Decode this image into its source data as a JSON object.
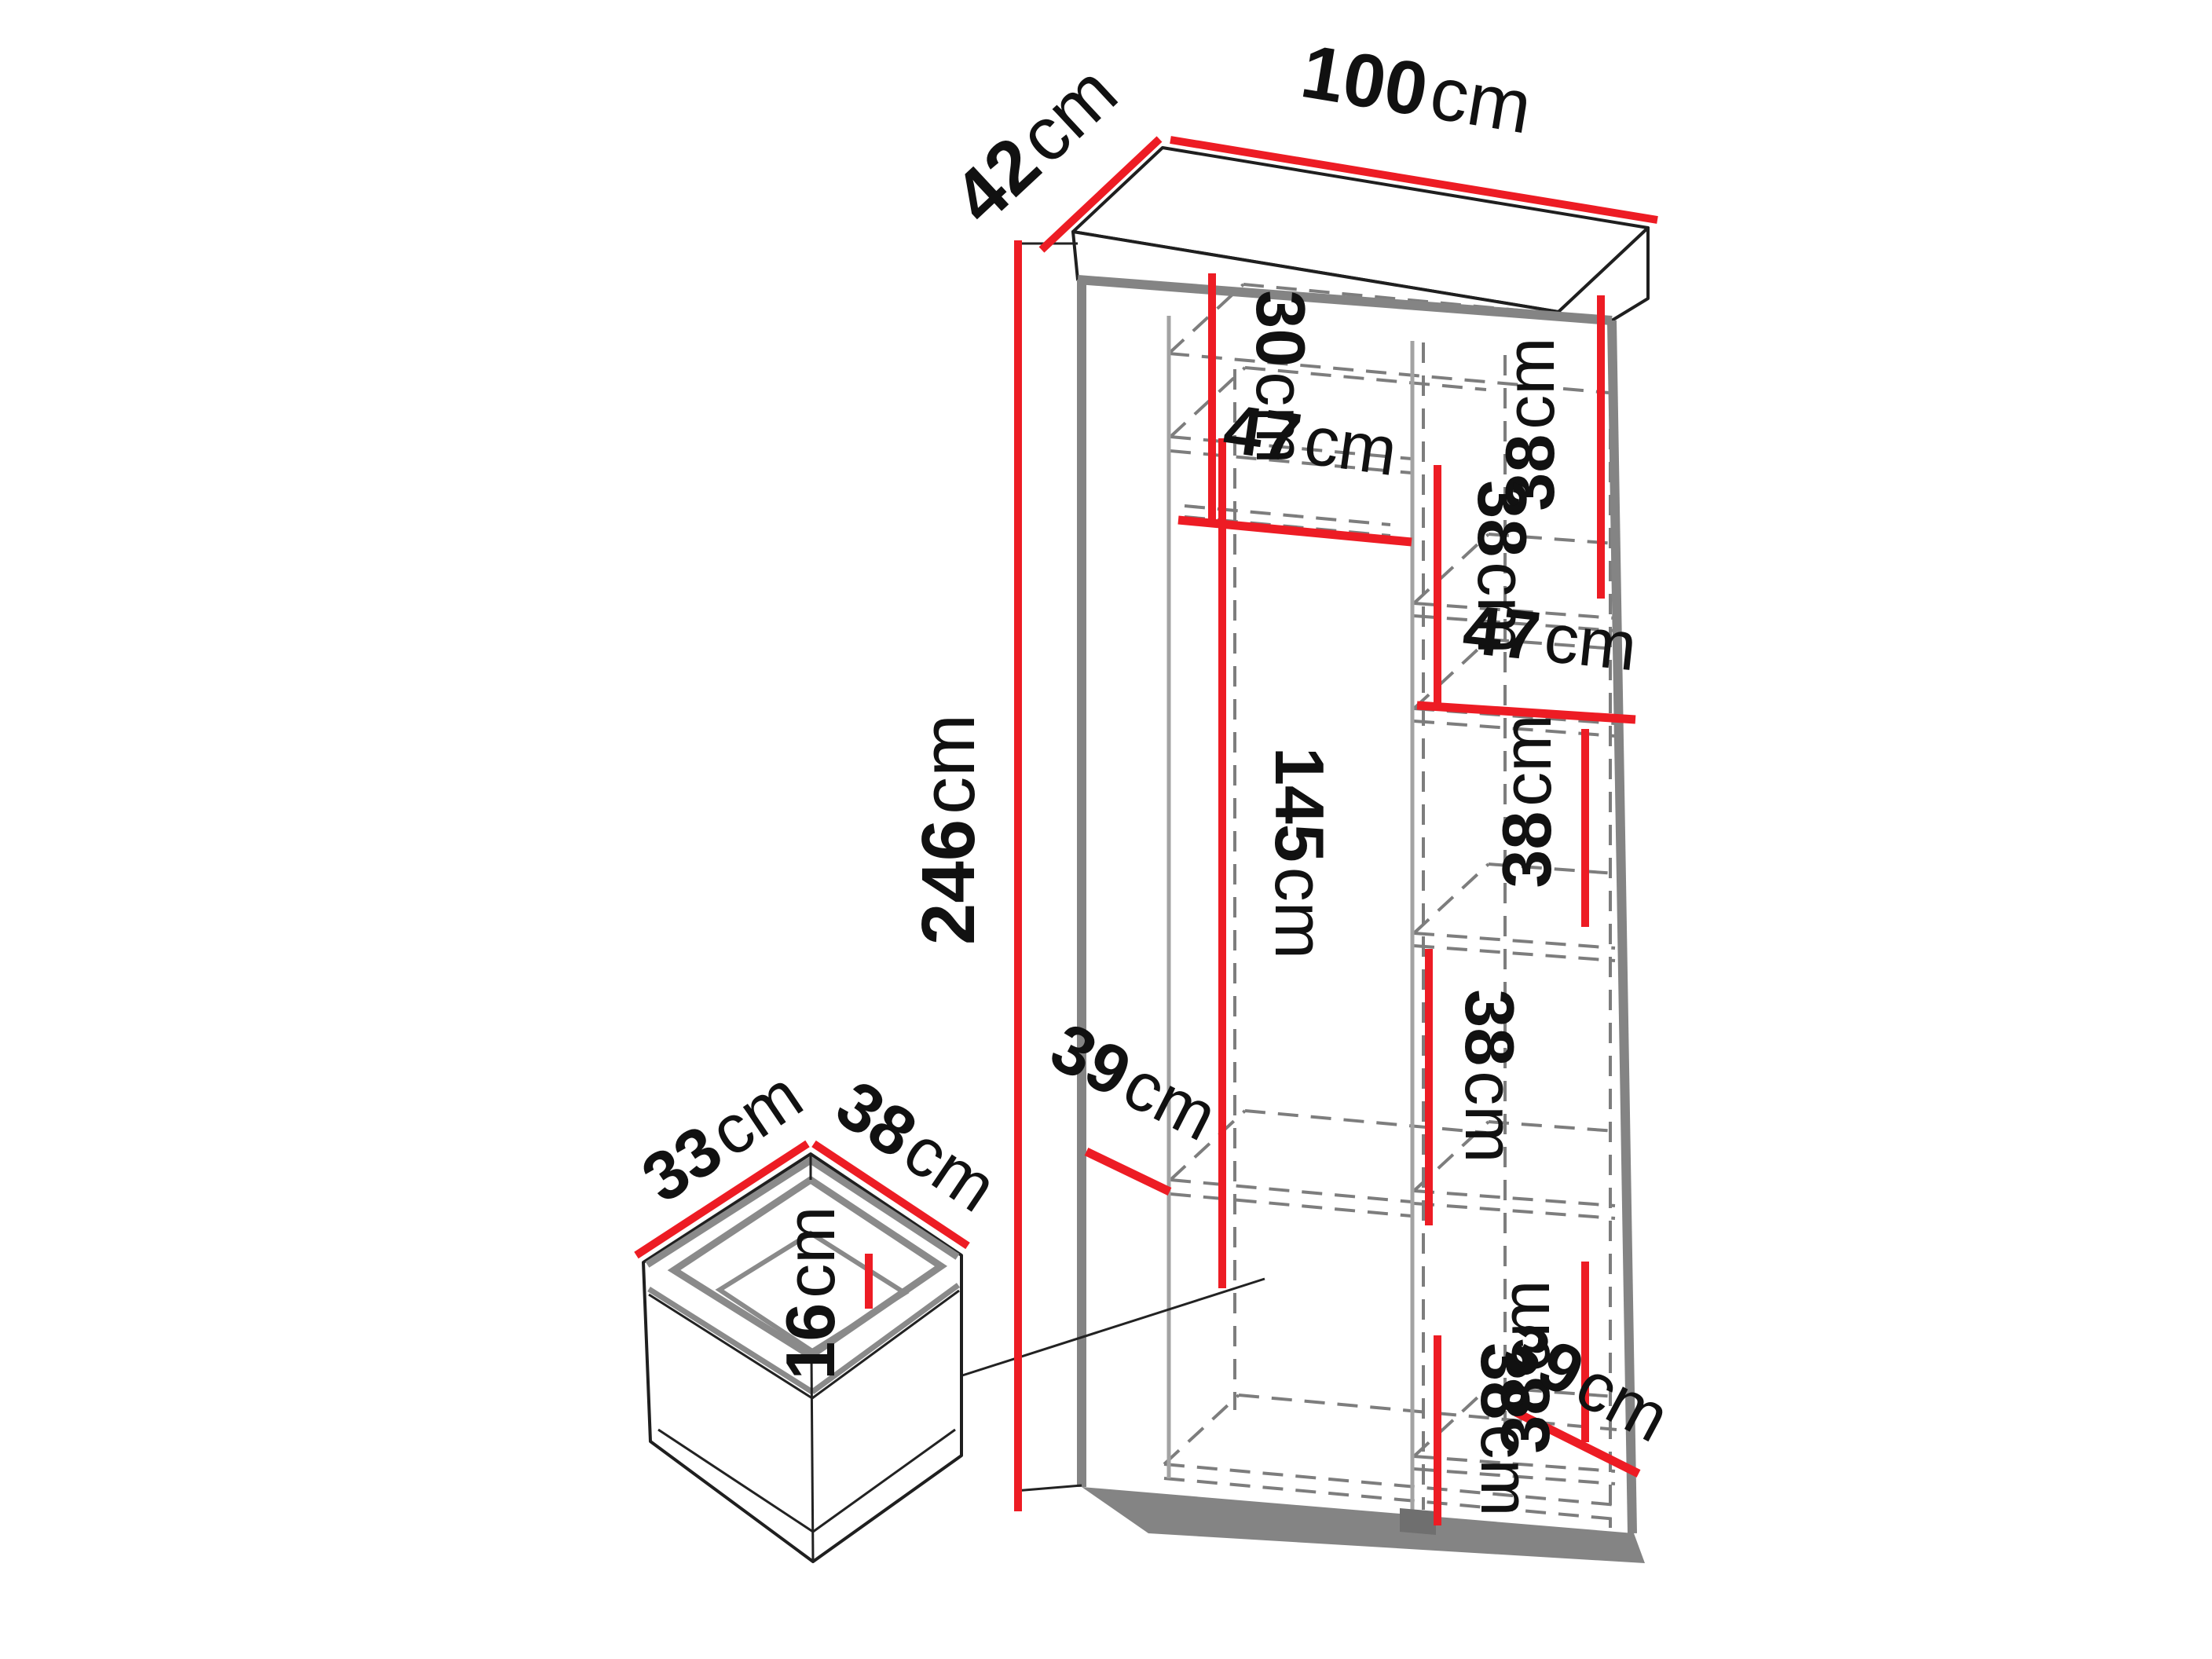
{
  "meta": {
    "background": "#ffffff",
    "accent_red": "#ED1C24",
    "edge_gray": "#848484",
    "text_color": "#111111",
    "diagram_type": "wardrobe-dimension-drawing"
  },
  "wardrobe": {
    "overall": {
      "width": {
        "num": "100",
        "unit": "cm"
      },
      "depth": {
        "num": "42",
        "unit": "cm"
      },
      "height": {
        "num": "246",
        "unit": "cm"
      }
    },
    "left_column": {
      "top_section_height": {
        "num": "30",
        "unit": "cm"
      },
      "shelf_width": {
        "num": "47",
        "unit": "cm"
      },
      "hanging_height": {
        "num": "145",
        "unit": "cm"
      },
      "shelf_depth": {
        "num": "39",
        "unit": "cm"
      }
    },
    "right_column": {
      "shelf_width": {
        "num": "47",
        "unit": "cm"
      },
      "bottom_depth": {
        "num": "39",
        "unit": "cm"
      },
      "section_heights": [
        {
          "num": "38",
          "unit": "cm"
        },
        {
          "num": "38",
          "unit": "cm"
        },
        {
          "num": "38",
          "unit": "cm"
        },
        {
          "num": "38",
          "unit": "cm"
        },
        {
          "num": "38",
          "unit": "cm"
        },
        {
          "num": "38",
          "unit": "cm"
        }
      ]
    }
  },
  "drawer": {
    "width": {
      "num": "33",
      "unit": "cm"
    },
    "depth": {
      "num": "38",
      "unit": "cm"
    },
    "height": {
      "num": "16",
      "unit": "cm"
    }
  }
}
